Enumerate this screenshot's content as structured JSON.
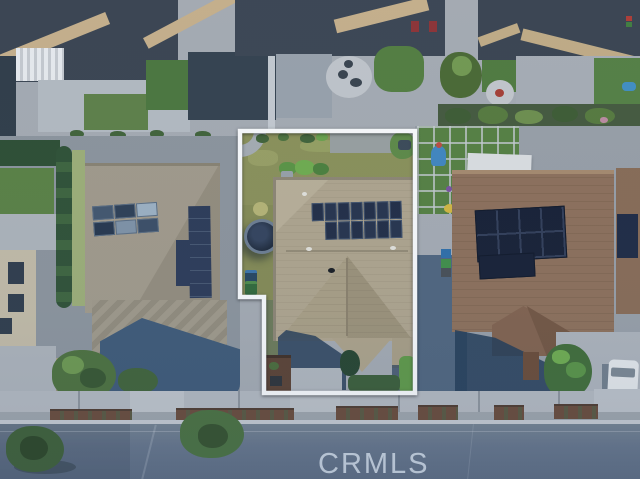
{
  "watermark": {
    "text": "CRMLS"
  },
  "outline": {
    "points": "240,131 415,131 415,393 264,393 264,297 240,297",
    "stroke_color": "#ffffff"
  },
  "scene": {
    "description": "Aerial top-down drone photo of a suburban neighborhood; subject parcel outlined in white",
    "subject_property": {
      "roof_color": "#b2a68c",
      "back_lawn_color": "#8c9156",
      "solar_array": {
        "rows": 2,
        "top_row_panels": 7,
        "bottom_row_panels": 6,
        "panel_color": "#1f2a42"
      },
      "objects": [
        "trampoline",
        "trash-bins",
        "planter-shrubs",
        "front-walkway",
        "mulch-planter",
        "hedges",
        "entry-porch-roof"
      ]
    },
    "left_neighbor": {
      "roof_color": "#a49b89",
      "solar_array": {
        "rows": 2,
        "columns": 3
      },
      "objects": [
        "hedge-row",
        "turf-strip",
        "shade-trees",
        "house-shadow",
        "striped-patio-roof"
      ]
    },
    "right_neighbor": {
      "roof_color": "#8f6f57",
      "solar_array": {
        "rows": 2,
        "columns": 4,
        "panel_color": "#141c30"
      },
      "objects": [
        "white-patio-cover",
        "grid-paver-turf",
        "play-slide",
        "trash-bins",
        "front-tree",
        "white-van",
        "driveway",
        "entry-porch-roof"
      ]
    },
    "top_row": {
      "objects": [
        "dark-shingle-roofs",
        "white-louvered-pergola",
        "concrete-patios",
        "turf-lawns",
        "round-paver-patio",
        "fire-pit",
        "garden-bed",
        "red-patio-chairs"
      ]
    },
    "streetscape": {
      "objects": [
        "sidewalk",
        "driveway-aprons",
        "parkway-mulch-planters",
        "curb",
        "asphalt-street",
        "street-trees"
      ]
    }
  },
  "palette": {
    "concrete": "#b7bbc0",
    "dark_roof": "#39424e",
    "tan_eave": "#c9b189",
    "turf_green": "#4e7b3a",
    "olive_lawn": "#8c9156",
    "shadow_blue": "#3d5875",
    "street": "#66748a",
    "watermark_text": "#dee6f0"
  }
}
